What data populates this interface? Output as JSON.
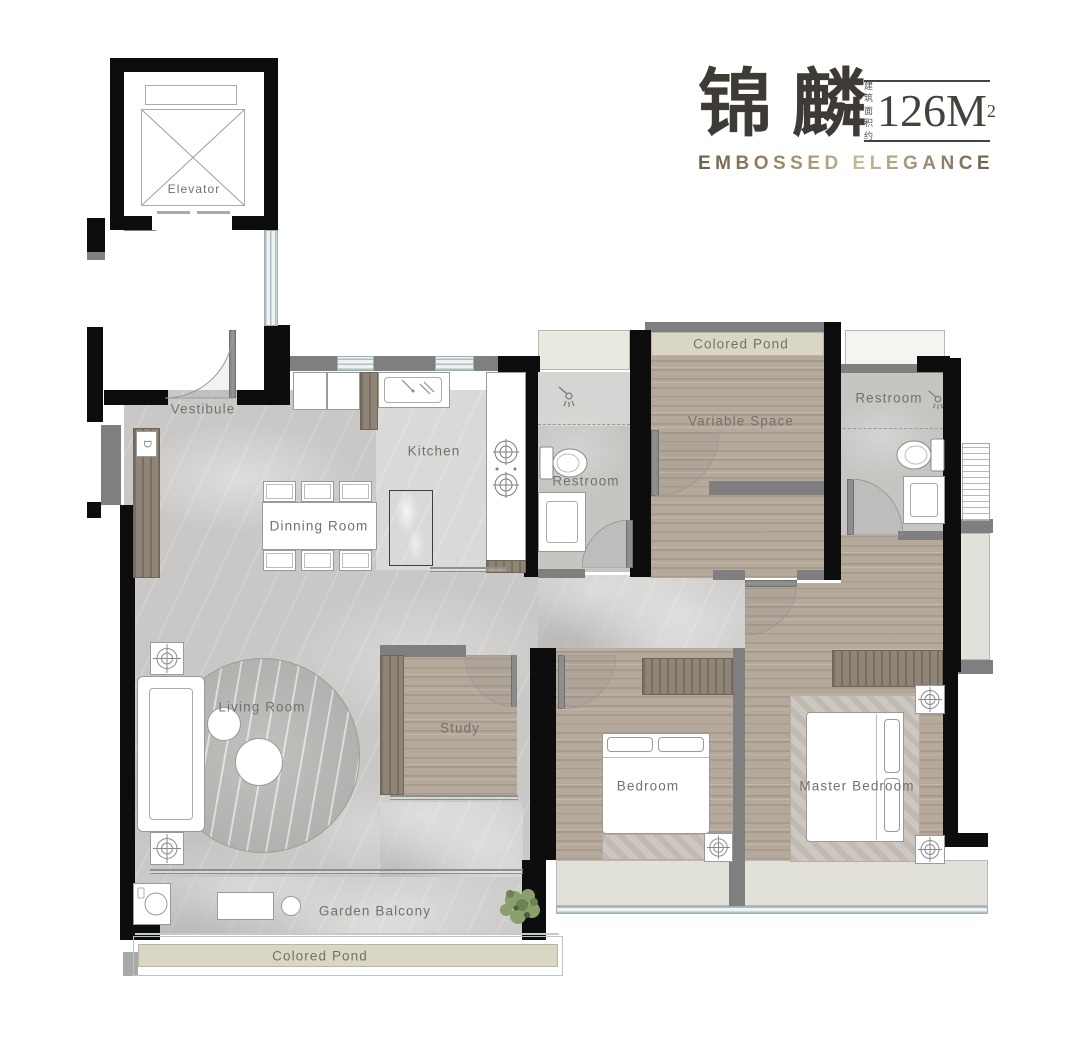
{
  "header": {
    "title_cn": "锦麟",
    "area_note_line1": "建筑",
    "area_note_line2": "面积约",
    "area_value": "126M",
    "area_superscript": "2",
    "subtitle": "EMBOSSED ELEGANCE"
  },
  "rooms": {
    "elevator": {
      "label": "Elevator"
    },
    "vestibule": {
      "label": "Vestibule"
    },
    "kitchen": {
      "label": "Kitchen"
    },
    "dining_room": {
      "label": "Dinning Room"
    },
    "restroom_center": {
      "label": "Restroom"
    },
    "restroom_right": {
      "label": "Restroom"
    },
    "variable_space": {
      "label": "Variable Space"
    },
    "living_room": {
      "label": "Living Room"
    },
    "study": {
      "label": "Study"
    },
    "bedroom": {
      "label": "Bedroom"
    },
    "master_bedroom": {
      "label": "Master Bedroom"
    },
    "garden_balcony": {
      "label": "Garden Balcony"
    },
    "colored_pond_top": {
      "label": "Colored Pond"
    },
    "colored_pond_bottom": {
      "label": "Colored Pond"
    }
  },
  "annotations": {
    "entry_cabinet": "D"
  },
  "colors": {
    "wall_black": "#0d0d0d",
    "wall_gray": "#7f7f7f",
    "marble_floor": "#c9c8c6",
    "wood_floor": "#b5a99b",
    "dark_wood": "#8f8476",
    "pond": "#d9d6c3",
    "window_bay": "#e2e1d9",
    "glass_line": "#aebfc2",
    "label_text": "#74716d",
    "title_text": "#3e3a35",
    "subtitle_bronze": "#8a795c"
  }
}
